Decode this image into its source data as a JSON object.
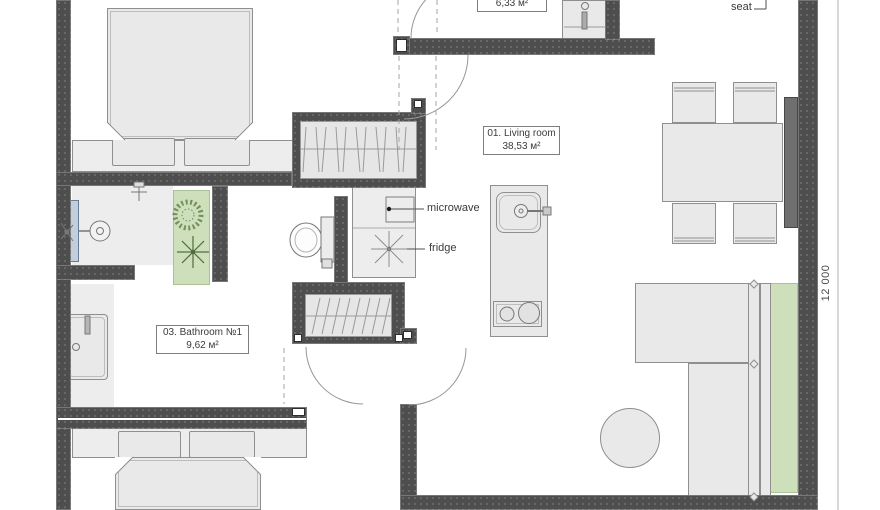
{
  "rooms": {
    "living_room": {
      "label": "01. Living room",
      "area": "38,53 м²"
    },
    "bathroom1": {
      "label": "03. Bathroom №1",
      "area": "9,62 м²"
    },
    "utility_room": {
      "area": "6,33 м²"
    }
  },
  "callouts": {
    "microwave": "microwave",
    "fridge": "fridge",
    "seat": "seat"
  },
  "dimensions": {
    "right_side": "12 000"
  },
  "colors": {
    "wall": "#4e4e4e",
    "furniture_fill": "#e9e9e9",
    "accent_green": "#cde0bb",
    "shower_glass": "#c3cedd",
    "bench": "#6f6f6f"
  }
}
